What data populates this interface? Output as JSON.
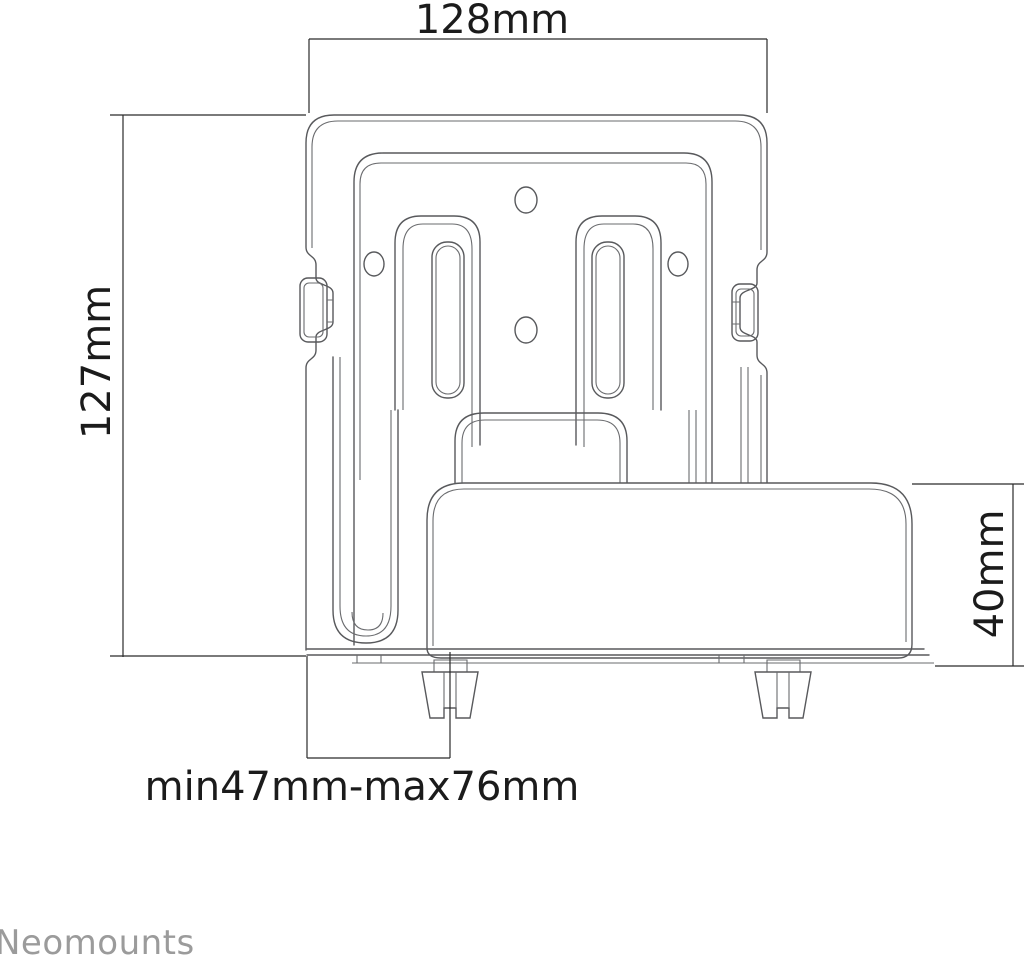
{
  "drawing": {
    "type": "technical-dimension-drawing",
    "subject": "media player wall mount bracket with device box, front/side composite view",
    "dimensions": {
      "top_width": "128mm",
      "left_height": "127mm",
      "bottom_depth_range": "min47mm-max76mm",
      "right_box_height": "40mm"
    },
    "brand": "Neomounts",
    "colors": {
      "background": "#ffffff",
      "drawing_line": "#58595c",
      "dimension_line": "#2b2b2b",
      "dimension_text": "#1b1b1b",
      "brand_text": "#9b9b9b"
    }
  }
}
